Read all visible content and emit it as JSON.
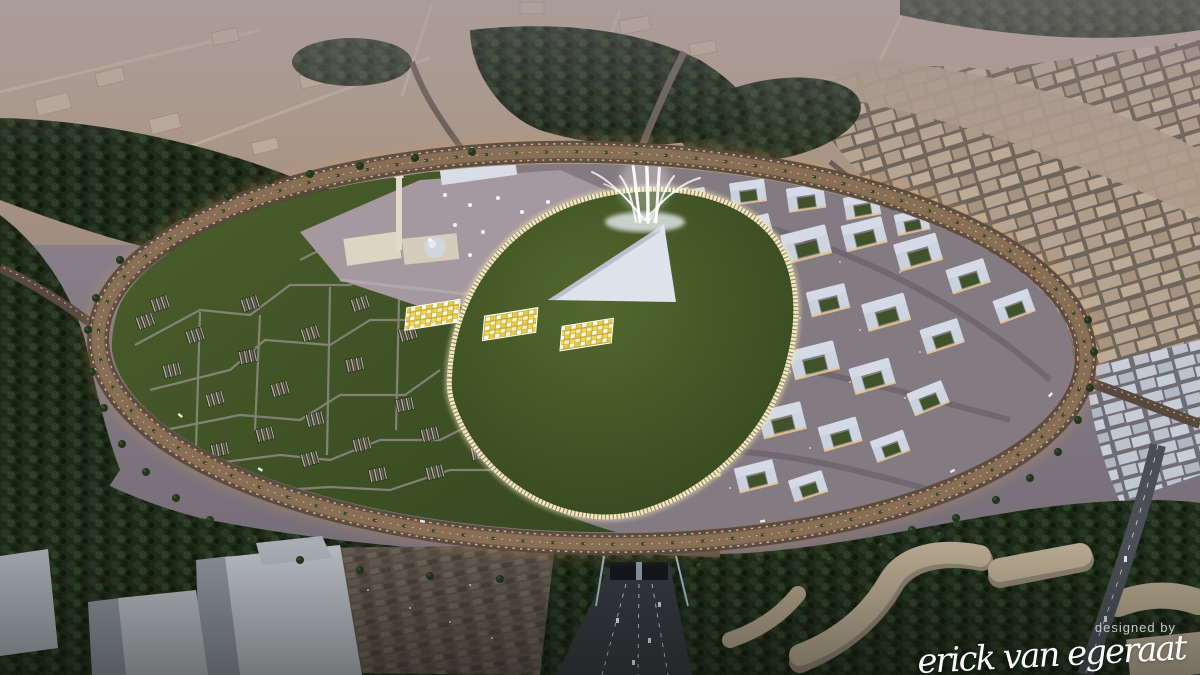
{
  "watermark": {
    "designed_by": "designed by",
    "signature": "erick van egeraat"
  },
  "palette": {
    "dusk_sky": "#8e8492",
    "desert_sand": "#b5a394",
    "foliage_dark": "#1e2a19",
    "ring_glow": "#e39b55",
    "streetlight_warm": "#f3c488",
    "green_roof": "#44582a",
    "louver_glow": "#f6e9bd",
    "white_building": "#d4dbe6",
    "skylight_yellow": "#eed94f",
    "plaza_stone": "#a3969b",
    "highway_asphalt": "#36373e",
    "massing_gray": "#b2b7bd",
    "context_tan": "#b5a491",
    "signature_white": "#ffffff"
  }
}
